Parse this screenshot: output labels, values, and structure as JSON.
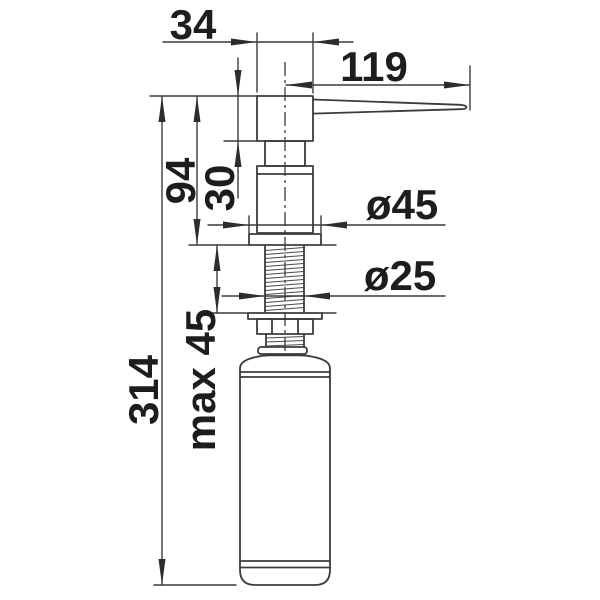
{
  "drawing": {
    "colors": {
      "line": "#3c3c3c",
      "text": "#1d1d1d",
      "background": "#ffffff"
    },
    "labels": {
      "head_width": "34",
      "spout_reach": "119",
      "height_above_counter": "94",
      "head_height": "30",
      "total_height": "314",
      "max_counter_thickness": "max 45",
      "flange_diameter": "ø45",
      "shank_diameter": "ø25"
    }
  }
}
